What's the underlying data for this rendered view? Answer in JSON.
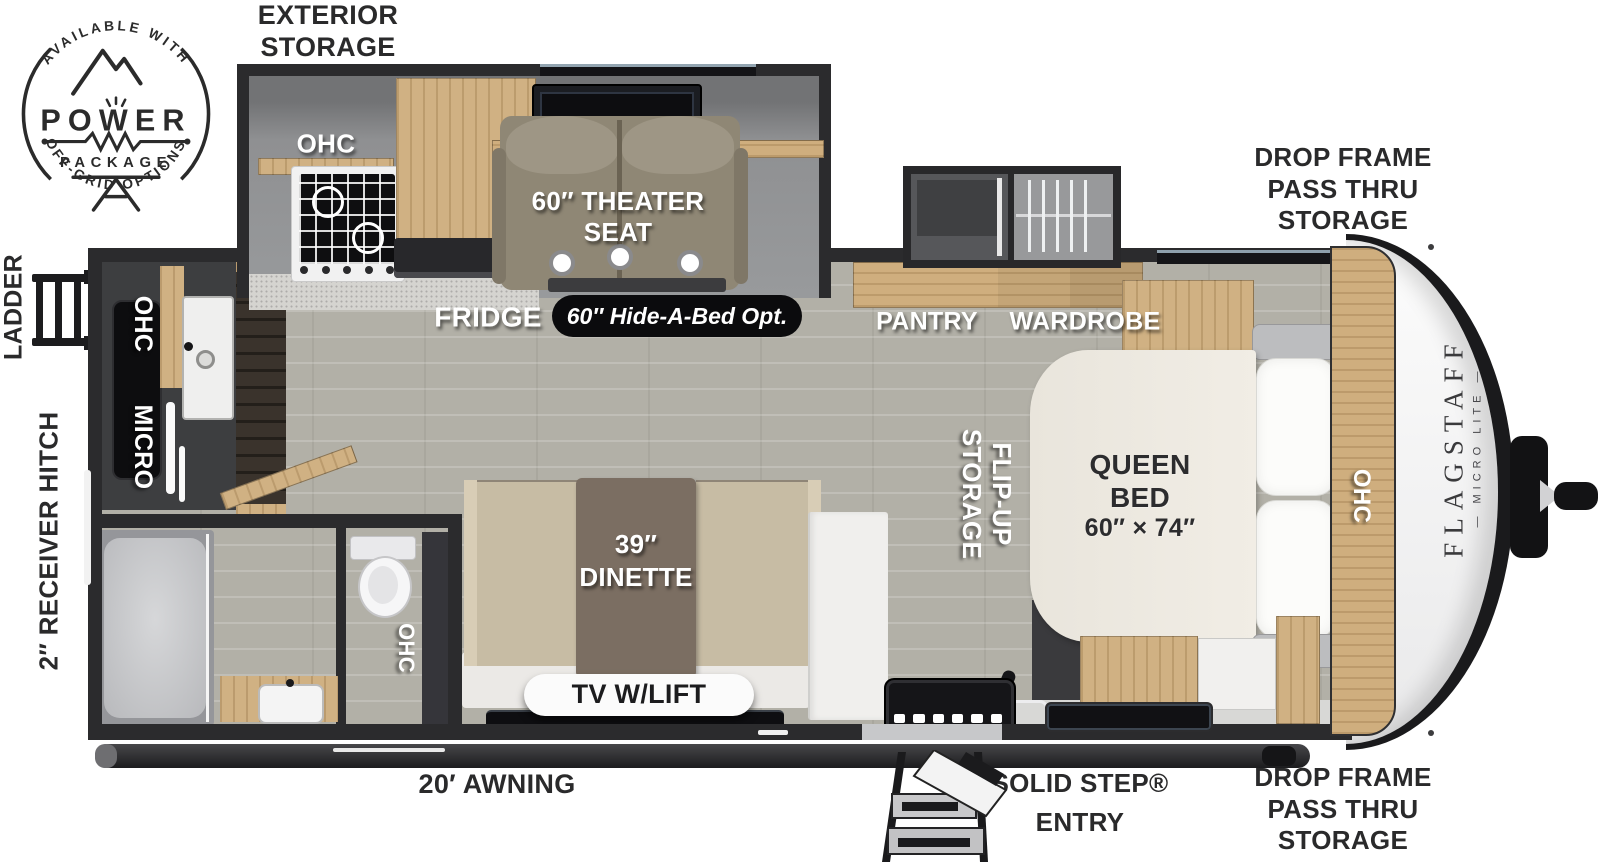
{
  "title": "Flagstaff Micro Lite travel trailer floor plan",
  "badge": {
    "arc_top": "AVAILABLE WITH",
    "name": "POWER",
    "package": "PACKAGE",
    "arc_bottom": "OFF-GRID OPTIONS"
  },
  "exterior": {
    "exterior_storage": [
      "EXTERIOR",
      "STORAGE"
    ],
    "drop_frame_top": [
      "DROP FRAME",
      "PASS THRU",
      "STORAGE"
    ],
    "drop_frame_bottom": [
      "DROP FRAME",
      "PASS THRU",
      "STORAGE"
    ],
    "ladder": "LADDER",
    "receiver_hitch": "2″ RECEIVER HITCH",
    "awning": "20′ AWNING",
    "solid_step": [
      "SOLID STEP®",
      "ENTRY"
    ]
  },
  "interior": {
    "slide_ohc": "OHC",
    "theater_seat": [
      "60″ THEATER",
      "SEAT"
    ],
    "fridge": "FRIDGE",
    "hide_a_bed": "60″ Hide-A-Bed Opt.",
    "pantry": "PANTRY",
    "wardrobe": "WARDROBE",
    "flip_up": [
      "FLIP-UP",
      "STORAGE"
    ],
    "queen_bed": [
      "QUEEN",
      "BED",
      "60″ × 74″"
    ],
    "bed_ohc": "OHC",
    "kitchen_ohc": "OHC",
    "kitchen_micro": "MICRO",
    "bath_ohc": "OHC",
    "dinette": [
      "39″",
      "DINETTE"
    ],
    "tv_lift": "TV W/LIFT"
  },
  "brand": {
    "name": "FLAGSTAFF",
    "model": "— MICRO LITE —"
  },
  "colors": {
    "wall": "#2b2b2d",
    "wood": "#d0b183",
    "floor": "#b2b0a7",
    "seat": "#8f8775",
    "bench": "#c7bca4",
    "bed": "#ece8e0",
    "label_dark": "#2a2a2b",
    "pill_dark": "#0b0b0d"
  }
}
